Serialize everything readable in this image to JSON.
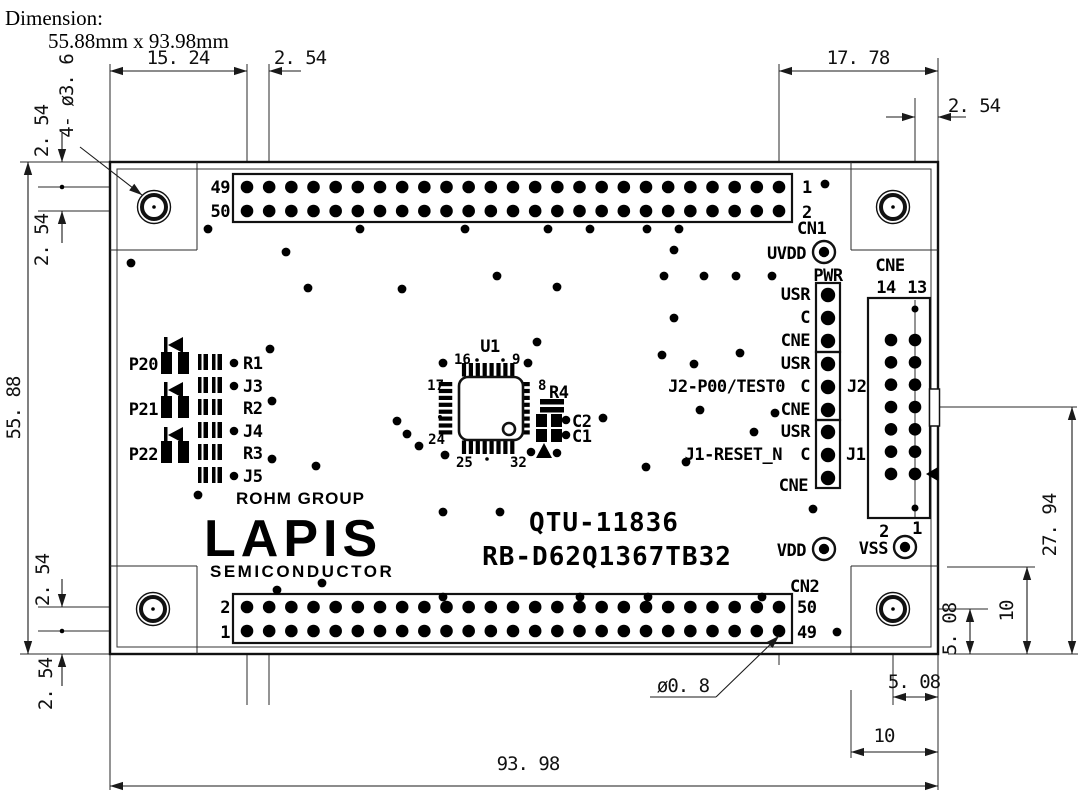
{
  "title": {
    "heading": "Dimension:",
    "size": "55.88mm x 93.98mm"
  },
  "dims": {
    "d15_24": "15. 24",
    "d2_54": "2. 54",
    "d17_78": "17. 78",
    "d55_88": "55. 88",
    "d27_94": "27. 94",
    "d10": "10",
    "d5_08": "5. 08",
    "d93_98": "93. 98",
    "dia0_8": "ø0. 8",
    "dia3_6": "4- ø3. 6"
  },
  "cn1": {
    "label": "CN1",
    "left_top": "49",
    "left_bottom": "50",
    "right_top": "1",
    "right_bottom": "2"
  },
  "cn2": {
    "label": "CN2",
    "left_top": "2",
    "left_bottom": "1",
    "right_top": "50",
    "right_bottom": "49"
  },
  "cne": {
    "label": "CNE",
    "top_left": "14",
    "top_right": "13",
    "bottom_left": "2",
    "bottom_right": "1"
  },
  "hdr": {
    "pwr": "PWR",
    "usr": "USR",
    "c": "C",
    "cne": "CNE",
    "j2": "J2",
    "j1": "J1",
    "j2_signal": "J2-P00/TEST0",
    "j1_signal": "J1-RESET_N"
  },
  "pads": {
    "uvdd": "UVDD",
    "vdd": "VDD",
    "vss": "VSS"
  },
  "u1": {
    "label": "U1",
    "p16": "16",
    "p9": "9",
    "p17": "17",
    "p8": "8",
    "p24": "24",
    "p25": "25",
    "p32": "32"
  },
  "parts": {
    "r4": "R4",
    "c2": "C2",
    "c1": "C1",
    "p20": "P20",
    "p21": "P21",
    "p22": "P22",
    "r1": "R1",
    "j3": "J3",
    "r2": "R2",
    "j4": "J4",
    "r3": "R3",
    "j5": "J5"
  },
  "brand": {
    "group": "ROHM GROUP",
    "name": "LAPIS",
    "sub": "SEMICONDUCTOR"
  },
  "ident": {
    "model": "QTU-11836",
    "part": "RB-D62Q1367TB32"
  }
}
